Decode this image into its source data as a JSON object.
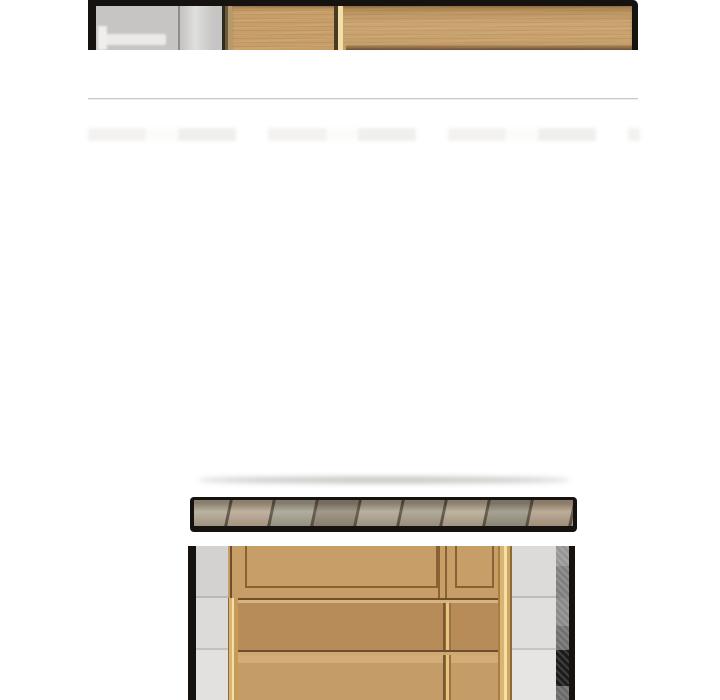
{
  "page": {
    "background": "#ffffff",
    "kind": "comic-reader-scroll-view"
  },
  "palette": {
    "frame_black": "#151210",
    "divider": "#c9c9c9",
    "wall_gray": "#c6c5c3",
    "wood_light": "#c79e68",
    "wood_honey": "#b78c58",
    "wood_pale": "#c49c68",
    "wood_frame_line": "#8a6134",
    "gold_trim": "#d9b472",
    "gold_highlight": "#f2e0ab",
    "dark_strip_top": "#969696",
    "dark_strip_mid": "#707070",
    "dark_strip_bottom": "#1c1c1c",
    "floor_seam": "#5a5143",
    "shadow": "rgba(120,115,105,0.45)"
  },
  "panels": {
    "top": {
      "name": "panel-top",
      "content": "cropped interior photo: grey wall section and light-oak wardrobe inside black frame"
    },
    "floor": {
      "name": "panel-floor-strip",
      "content": "narrow black-framed strip of angled wood floor planks",
      "plank_colors": [
        "#b3a995",
        "#baa893",
        "#a8a492",
        "#978d7d",
        "#b1a795",
        "#aaa18f",
        "#b8ab96",
        "#9d9787",
        "#b4a28c",
        "#a7a391",
        "#b0a492",
        "#968e7e"
      ]
    },
    "cabinet": {
      "name": "panel-cabinet",
      "content": "photo of light-oak cabinet front with grey sides, cropped by viewport bottom"
    }
  }
}
